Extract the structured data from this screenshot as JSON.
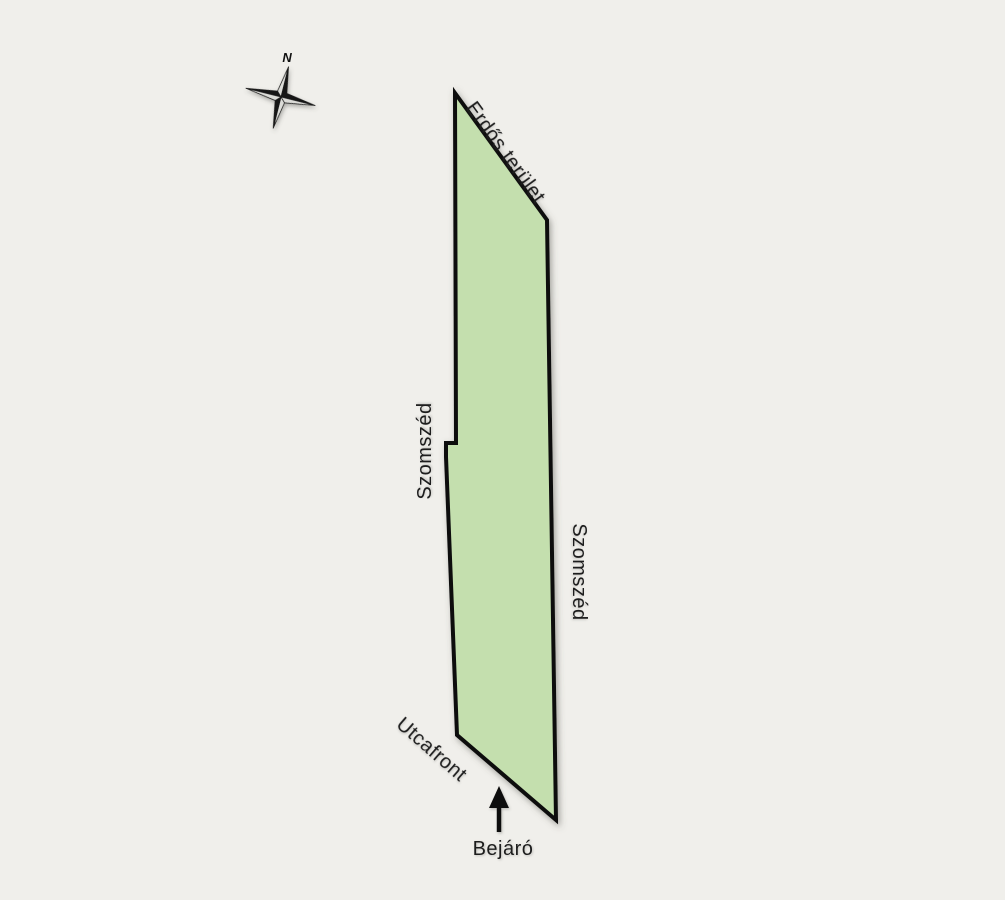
{
  "page": {
    "background_color": "#f0efeb"
  },
  "compass": {
    "north_label": "N",
    "dark_color": "#161616",
    "light_color": "#dcdcd8",
    "outline_color": "#1a1a1a"
  },
  "parcel": {
    "fill_color": "#c4dfae",
    "outline_color": "#0d0d0d",
    "points": "455,93 547,220 556,820 457,735 446,457 446,443 456,443"
  },
  "labels": {
    "forest_area": "Erdős terület",
    "neighbor_left": "Szomszéd",
    "neighbor_right": "Szomszéd",
    "street_front": "Utcafront",
    "entrance": "Bejáró"
  },
  "entrance_arrow": {
    "color": "#111111"
  }
}
